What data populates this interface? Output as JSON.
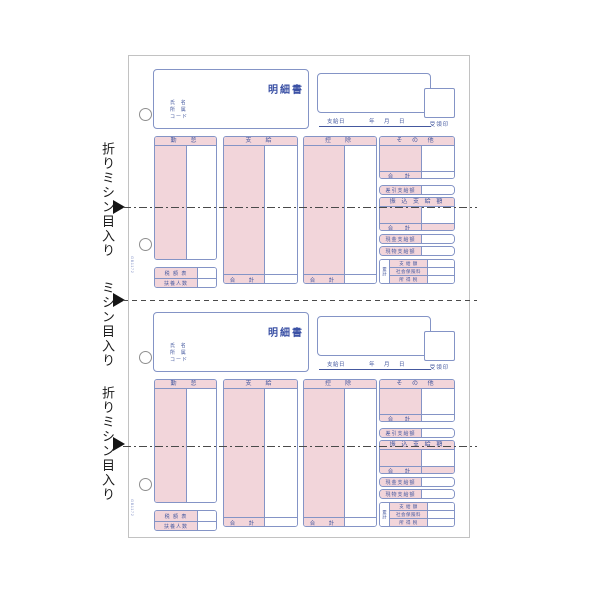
{
  "annotations": {
    "labels": [
      {
        "text": "折りミシン目入り"
      },
      {
        "text": "ミシン目入り"
      },
      {
        "text": "折りミシン目入り"
      }
    ]
  },
  "form": {
    "title": "明細書",
    "code": "GB1172",
    "name_label": "氏  名",
    "dept_label": "所  属",
    "code_label": "コード",
    "pay_date_label": "支給日",
    "date_units": "年　月　日",
    "receipt_label": "受領印",
    "col_attendance": "勤　怠",
    "col_payment": "支　給",
    "col_deduction": "控　除",
    "col_other": "そ の 他",
    "total_label": "合　計",
    "tax_table_label": "税 額 表",
    "dependents_label": "扶養人数",
    "net_pay_label": "差引支給額",
    "transfer_label": "振 込 支 給 額",
    "cash_label": "現金支給額",
    "inkind_label": "現物支給額",
    "cumulative_label": "累計",
    "cum_row_pay": "支 給 額",
    "cum_row_insurance": "社会保険料",
    "cum_row_tax": "所 得 税"
  },
  "colors": {
    "pink": "#f2d5da",
    "line_blue": "#8494c6",
    "text_blue": "#44589f",
    "annotation_ink": "#1a1a1a"
  }
}
